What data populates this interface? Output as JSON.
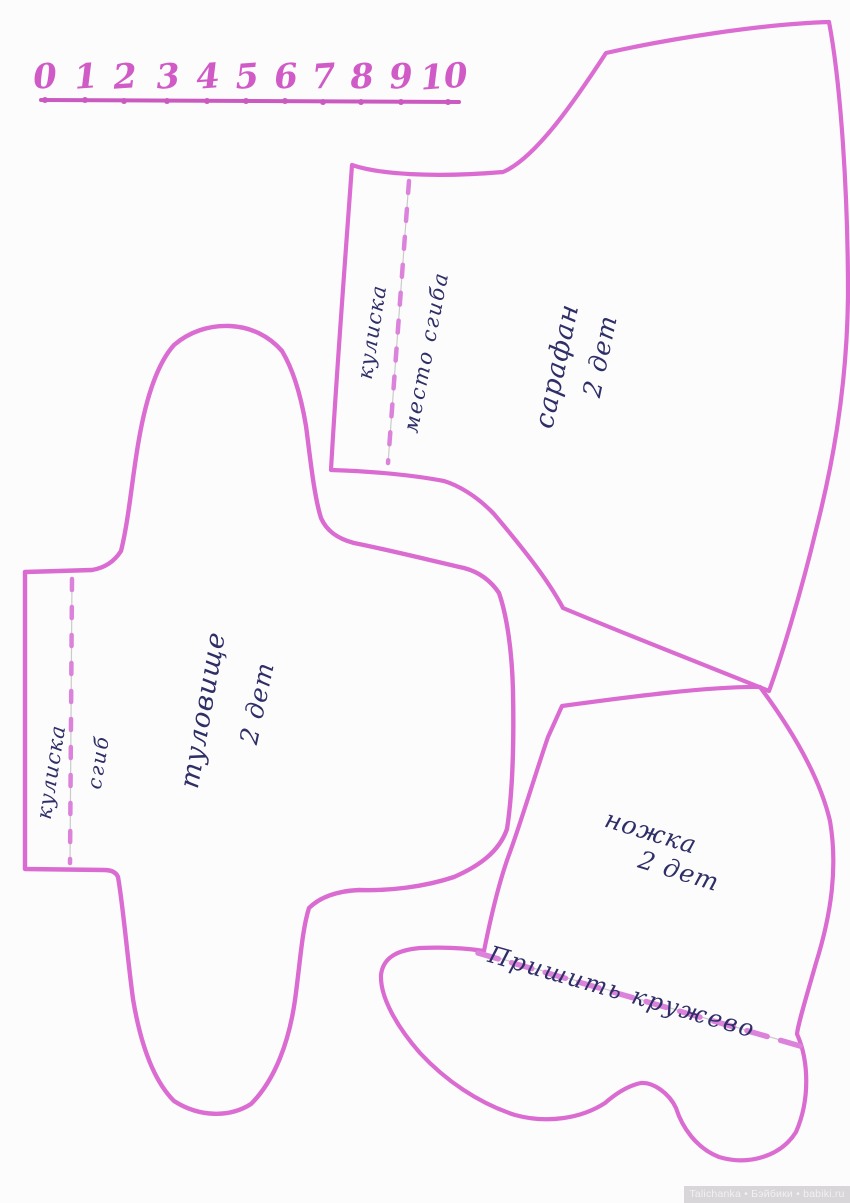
{
  "ruler": {
    "numbers": [
      "0",
      "1",
      "2",
      "3",
      "4",
      "5",
      "6",
      "7",
      "8",
      "9",
      "10"
    ]
  },
  "pieces": {
    "sarafan": {
      "label": "сарафан",
      "quantity": "2 дет",
      "channel_label": "кулиска",
      "fold_label": "место сгиба"
    },
    "torso": {
      "label": "туловище",
      "quantity": "2 дет",
      "channel_label": "кулиска",
      "fold_label": "сгиб"
    },
    "leg": {
      "label": "ножка",
      "quantity": "2 дет",
      "lace_label": "Пришить кружево"
    }
  },
  "watermark": {
    "text": "Talichanka • Бэйбики • babiki.ru"
  },
  "colors": {
    "outline": "#d85fce",
    "dash": "#d979d8",
    "pencil": "#c6c6c6",
    "ink": "#2f2f68",
    "ruler_number": "#d05ac6",
    "ruler_line": "#c64dba"
  }
}
